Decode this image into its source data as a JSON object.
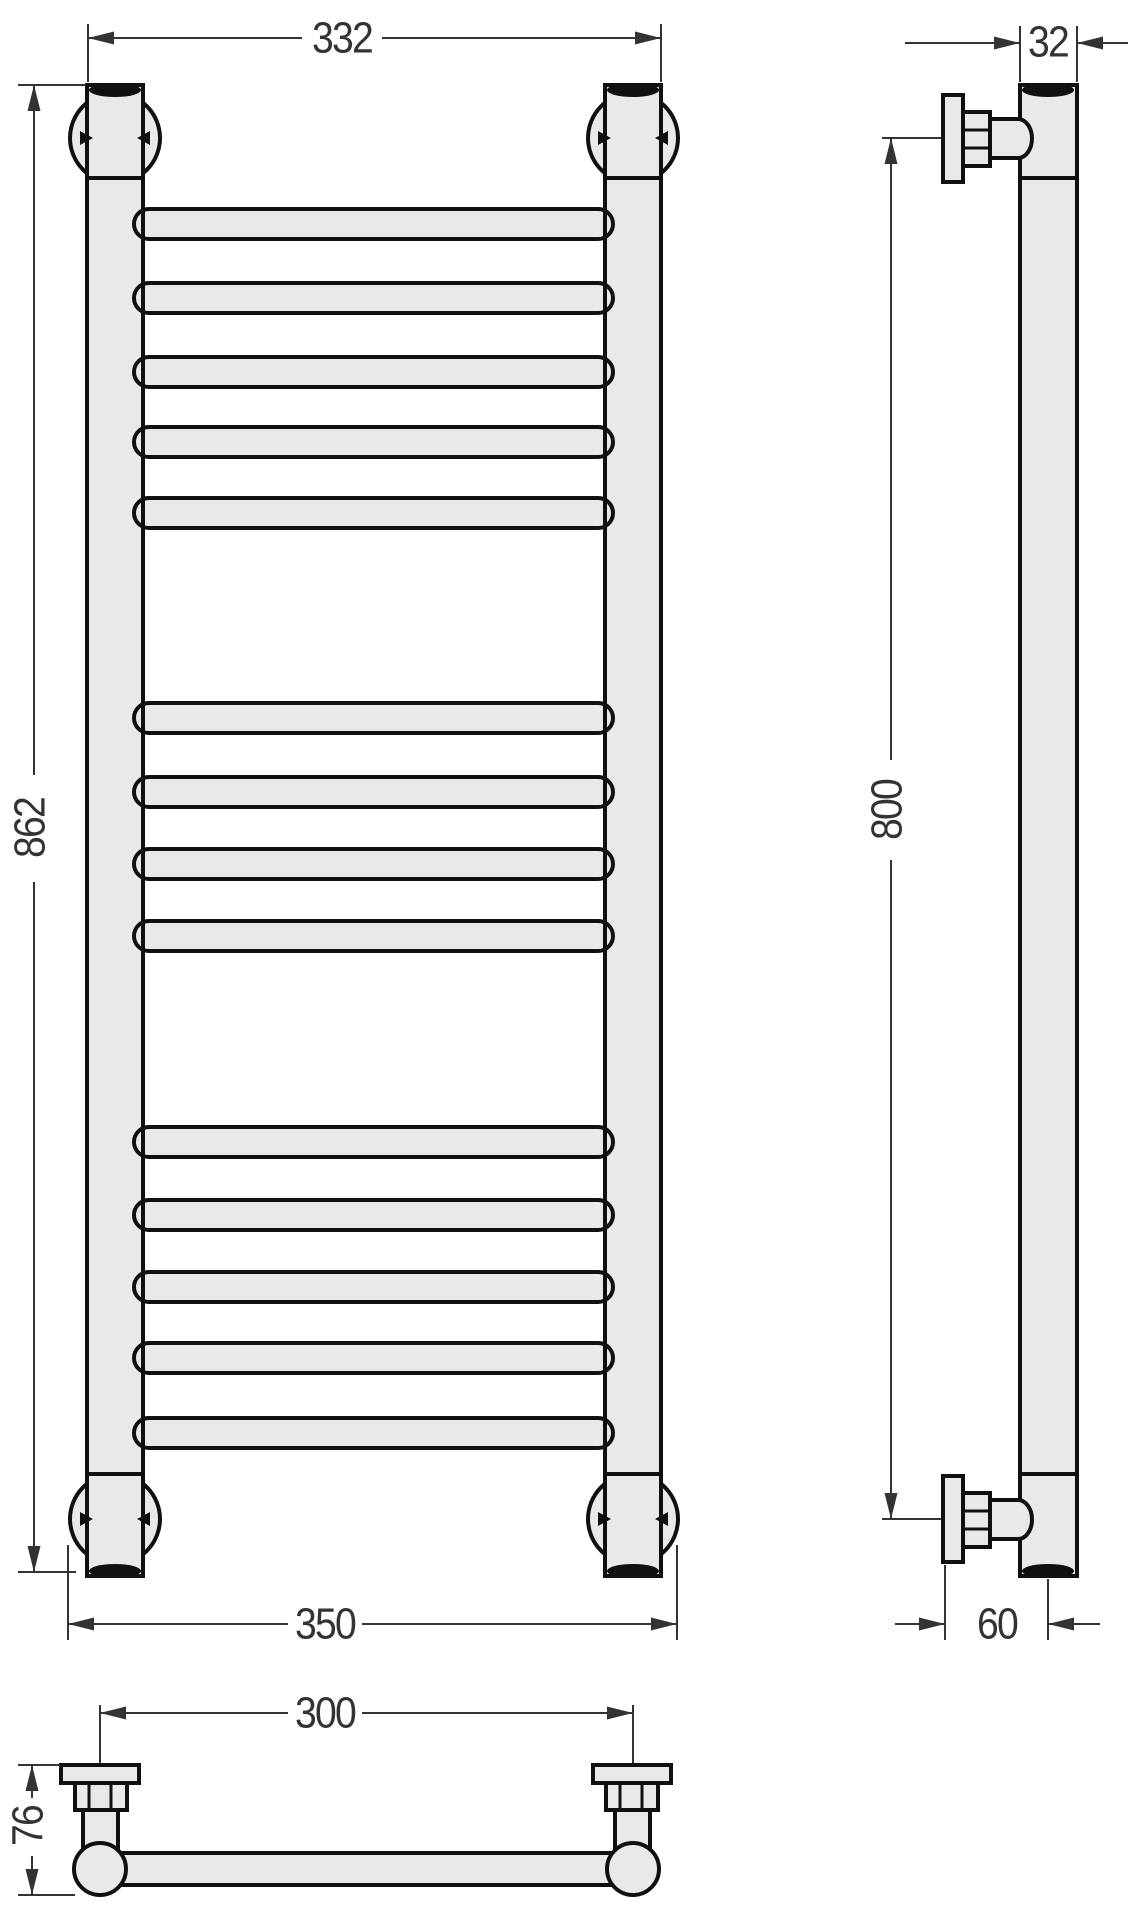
{
  "page": {
    "title": "Heated towel rail — dimensional drawing"
  },
  "drawing": {
    "object": "ladder heated towel rail, three orthographic views (front, side, plan)",
    "colors": {
      "fill": "#e9e9e9",
      "outline": "#101010",
      "cap": "#101010",
      "dim": "#333333",
      "bg": "#ffffff"
    },
    "rungs": {
      "count": 14,
      "groups": [
        5,
        4,
        5
      ]
    },
    "dimensions_mm": {
      "front_top_width": "332",
      "front_height": "862",
      "front_bottom_width": "350",
      "side_tube_width": "32",
      "side_mount_pitch": "800",
      "side_wall_offset": "60",
      "plan_mount_pitch": "300",
      "plan_depth": "76"
    }
  },
  "geometry": {
    "canvas": {
      "w": 1142,
      "h": 1920
    },
    "front": {
      "posts": [
        {
          "x": 87,
          "y": 85,
          "w": 56,
          "h": 1491
        },
        {
          "x": 605,
          "y": 85,
          "w": 56,
          "h": 1491
        }
      ],
      "joints_y": [
        178,
        1474
      ],
      "rim_rx": 26,
      "rim_ry": 7,
      "rims": [
        {
          "cx": 115,
          "cy": 90
        },
        {
          "cx": 633,
          "cy": 90
        },
        {
          "cx": 115,
          "cy": 1571
        },
        {
          "cx": 633,
          "cy": 1571
        }
      ],
      "circle_r": 45,
      "circles": [
        {
          "cx": 115,
          "cy": 138
        },
        {
          "cx": 633,
          "cy": 138
        },
        {
          "cx": 115,
          "cy": 1519
        },
        {
          "cx": 633,
          "cy": 1519
        }
      ],
      "rungs": {
        "x": 134,
        "w": 479,
        "h": 30,
        "tops": [
          209,
          283,
          357,
          427,
          498,
          703,
          777,
          849,
          921,
          1127,
          1200,
          1272,
          1343,
          1418
        ]
      }
    },
    "side": {
      "bar": {
        "x": 1020,
        "y": 85,
        "w": 57,
        "h": 1491
      },
      "joints_y": [
        178,
        1474
      ],
      "rims": [
        {
          "cx": 1048,
          "cy": 90
        },
        {
          "cx": 1048,
          "cy": 1571
        }
      ],
      "brackets": [
        {
          "flange": [
            943,
            95,
            20,
            87
          ],
          "hex": [
            963,
            112,
            27,
            54
          ],
          "hex_lines": [
            130,
            148
          ],
          "cyl": [
            990,
            119,
            28,
            39
          ]
        },
        {
          "flange": [
            943,
            1476,
            20,
            86
          ],
          "hex": [
            963,
            1493,
            27,
            54
          ],
          "hex_lines": [
            1511,
            1529
          ],
          "cyl": [
            990,
            1500,
            28,
            39
          ]
        }
      ]
    },
    "plan": {
      "bar": [
        100,
        1853,
        533,
        32
      ],
      "circle_r": 26,
      "circles": [
        {
          "cx": 100,
          "cy": 1869
        },
        {
          "cx": 633,
          "cy": 1869
        }
      ],
      "cyls": [
        [
          83,
          1810,
          35,
          42
        ],
        [
          615,
          1810,
          35,
          42
        ]
      ],
      "hexes": [
        {
          "r": [
            75,
            1783,
            52,
            27
          ],
          "lines": [
            89,
            111
          ]
        },
        {
          "r": [
            606,
            1783,
            52,
            27
          ],
          "lines": [
            620,
            642
          ]
        }
      ],
      "flanges": [
        [
          61,
          1765,
          78,
          18
        ],
        [
          593,
          1765,
          78,
          18
        ]
      ]
    },
    "dims": [
      {
        "label": "332",
        "name": "front-top-width",
        "text": [
          342,
          38,
          0
        ],
        "seg": [
          [
            88,
            38,
            302,
            38
          ],
          [
            382,
            38,
            661,
            38
          ]
        ],
        "arr": [
          [
            88,
            38,
            "left"
          ],
          [
            661,
            38,
            "right"
          ]
        ],
        "ext": [
          [
            88,
            24,
            88,
            82
          ],
          [
            661,
            24,
            661,
            82
          ]
        ]
      },
      {
        "label": "862",
        "name": "front-height",
        "text": [
          30,
          828,
          -90
        ],
        "seg": [
          [
            34,
            85,
            34,
            775
          ],
          [
            34,
            882,
            34,
            1572
          ]
        ],
        "arr": [
          [
            34,
            85,
            "up"
          ],
          [
            34,
            1572,
            "down"
          ]
        ],
        "ext": [
          [
            18,
            85,
            86,
            85
          ],
          [
            18,
            1572,
            76,
            1572
          ]
        ]
      },
      {
        "label": "350",
        "name": "front-bottom-width",
        "text": [
          325,
          1624,
          0
        ],
        "seg": [
          [
            68,
            1624,
            288,
            1624
          ],
          [
            362,
            1624,
            677,
            1624
          ]
        ],
        "arr": [
          [
            68,
            1624,
            "left"
          ],
          [
            677,
            1624,
            "right"
          ]
        ],
        "ext": [
          [
            68,
            1545,
            68,
            1640
          ],
          [
            677,
            1545,
            677,
            1640
          ]
        ]
      },
      {
        "label": "32",
        "name": "side-tube-width",
        "text": [
          1048,
          42,
          0
        ],
        "seg": [
          [
            905,
            43,
            1020,
            43
          ],
          [
            1077,
            43,
            1128,
            43
          ]
        ],
        "arr": [
          [
            1020,
            43,
            "right"
          ],
          [
            1077,
            43,
            "left"
          ]
        ],
        "ext": [
          [
            1020,
            26,
            1020,
            82
          ],
          [
            1077,
            26,
            1077,
            82
          ]
        ]
      },
      {
        "label": "800",
        "name": "side-mount-pitch",
        "text": [
          887,
          810,
          -90
        ],
        "seg": [
          [
            891,
            138,
            891,
            760
          ],
          [
            891,
            860,
            891,
            1519
          ]
        ],
        "arr": [
          [
            891,
            138,
            "up"
          ],
          [
            891,
            1519,
            "down"
          ]
        ],
        "ext": [
          [
            882,
            138,
            941,
            138
          ],
          [
            882,
            1519,
            941,
            1519
          ]
        ]
      },
      {
        "label": "60",
        "name": "side-wall-offset",
        "text": [
          997,
          1624,
          0
        ],
        "seg": [
          [
            895,
            1624,
            945,
            1624
          ],
          [
            1048,
            1624,
            1100,
            1624
          ]
        ],
        "arr": [
          [
            945,
            1624,
            "right"
          ],
          [
            1048,
            1624,
            "left"
          ]
        ],
        "ext": [
          [
            945,
            1565,
            945,
            1640
          ],
          [
            1048,
            1579,
            1048,
            1640
          ]
        ]
      },
      {
        "label": "300",
        "name": "plan-mount-pitch",
        "text": [
          325,
          1713,
          0
        ],
        "seg": [
          [
            100,
            1713,
            288,
            1713
          ],
          [
            362,
            1713,
            633,
            1713
          ]
        ],
        "arr": [
          [
            100,
            1713,
            "left"
          ],
          [
            633,
            1713,
            "right"
          ]
        ],
        "ext": [
          [
            100,
            1705,
            100,
            1763
          ],
          [
            633,
            1705,
            633,
            1763
          ]
        ]
      },
      {
        "label": "76",
        "name": "plan-depth",
        "text": [
          28,
          1826,
          -90
        ],
        "seg": [
          [
            32,
            1765,
            32,
            1798
          ],
          [
            32,
            1856,
            32,
            1895
          ]
        ],
        "arr": [
          [
            32,
            1765,
            "up"
          ],
          [
            32,
            1895,
            "down"
          ]
        ],
        "ext": [
          [
            18,
            1765,
            60,
            1765
          ],
          [
            18,
            1895,
            75,
            1895
          ]
        ]
      }
    ]
  }
}
